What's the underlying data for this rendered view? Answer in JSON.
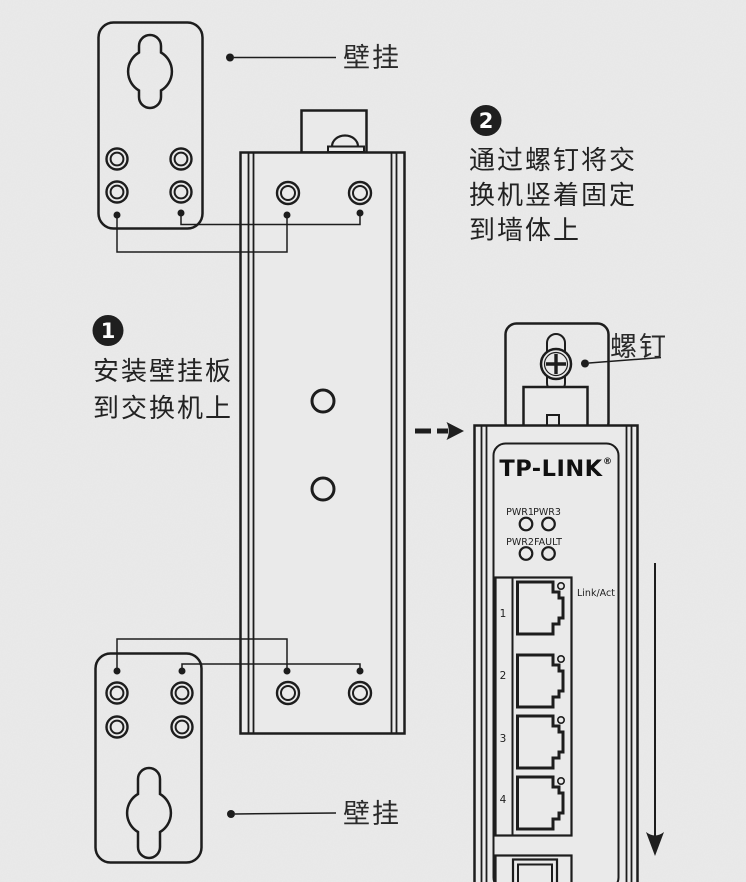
{
  "colors": {
    "background": "#eaeaea",
    "line": "#1d1d1d",
    "text": "#2a2a2a",
    "badge_fill": "#1f1f1f",
    "badge_text": "#ffffff"
  },
  "callouts": {
    "wall_mount_top": "壁挂",
    "wall_mount_bottom": "壁挂",
    "screw": "螺钉"
  },
  "steps": [
    {
      "number": "1",
      "lines": [
        "安装壁挂板",
        "到交换机上"
      ]
    },
    {
      "number": "2",
      "lines": [
        "通过螺钉将交",
        "换机竖着固定",
        "到墙体上"
      ]
    }
  ],
  "device_front": {
    "brand": "TP-LINK",
    "brand_mark": "®",
    "led_row1": [
      "PWR1",
      "PWR3"
    ],
    "led_row2": [
      "PWR2",
      "FAULT"
    ],
    "port_numbers": [
      "1",
      "2",
      "3",
      "4"
    ],
    "port_led_label": "Link/Act"
  }
}
